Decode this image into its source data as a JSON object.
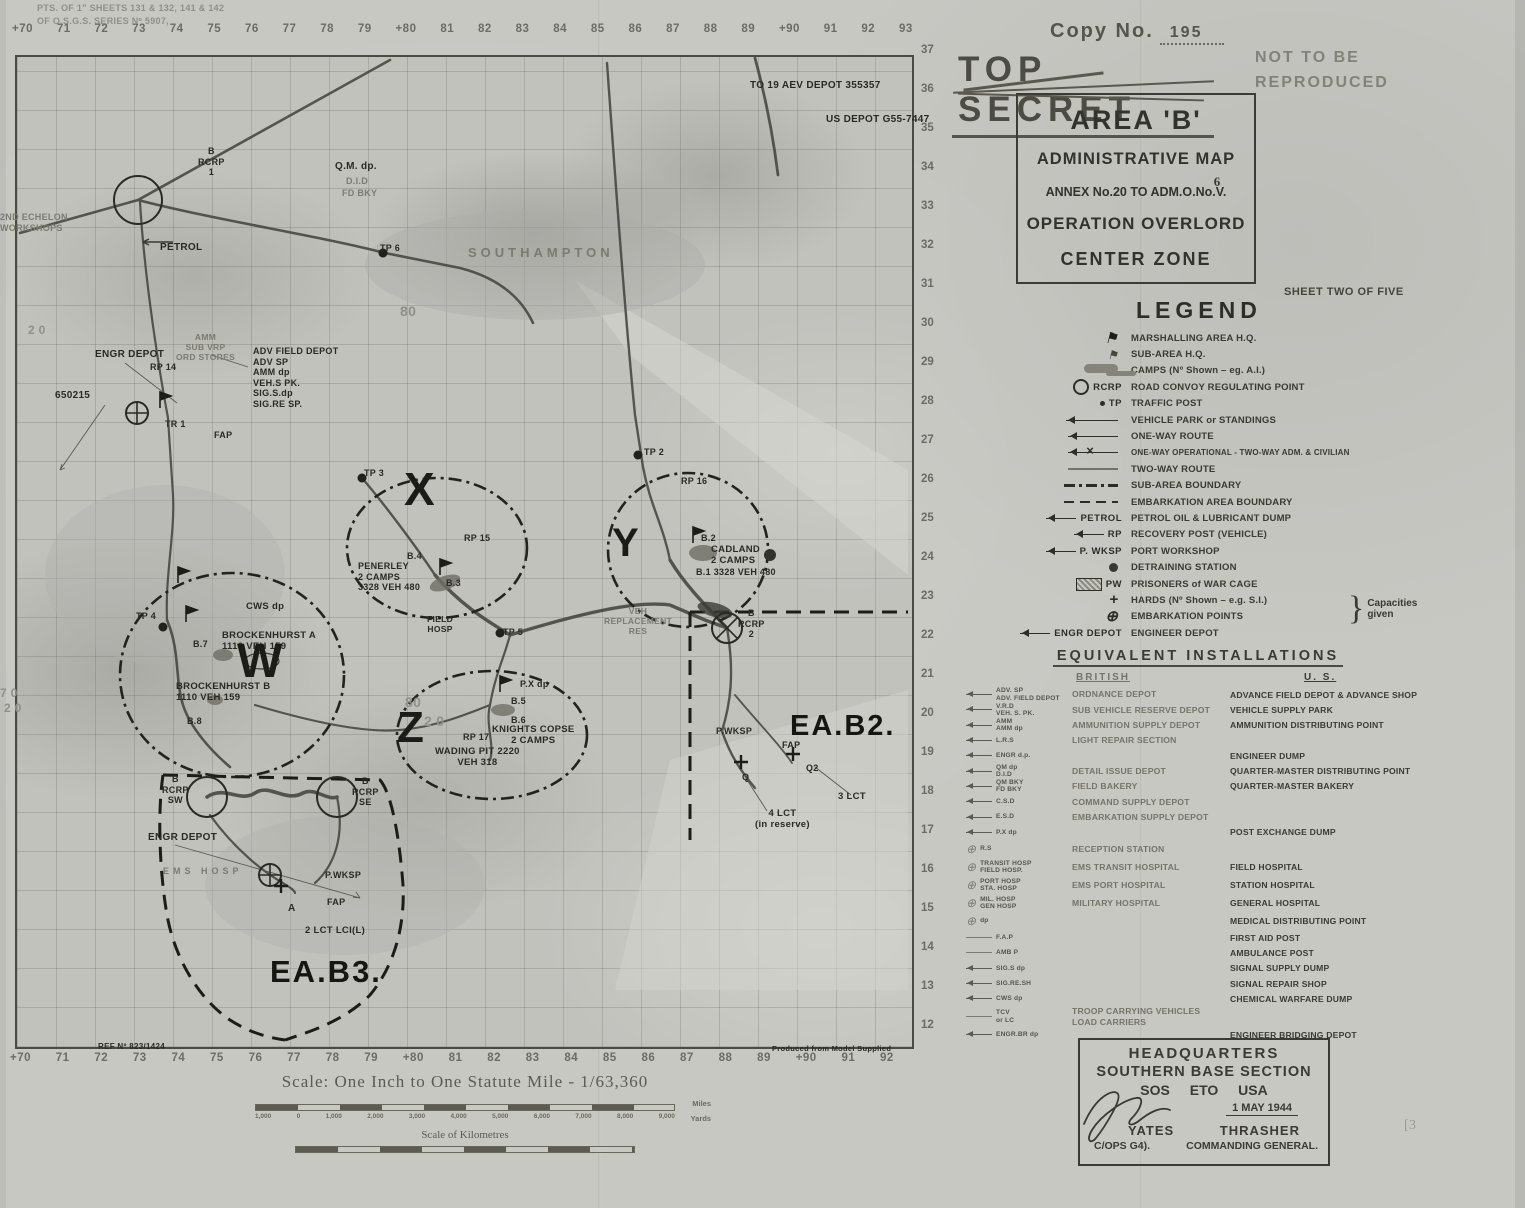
{
  "header": {
    "copy_prefix": "Copy  No.",
    "copy_number": "195",
    "classification": "TOP SECRET",
    "not_reproduced": "NOT TO BE\nREPRODUCED",
    "area_title": "AREA 'B'",
    "subtitle": "ADMINISTRATIVE MAP",
    "annex_prefix": "ANNEX No.20 TO ADM.O.No.",
    "annex_v": "V.",
    "annex_six": "6",
    "operation": "OPERATION OVERLORD",
    "zone": "CENTER ZONE",
    "sheet": "SHEET TWO OF FIVE"
  },
  "legend": {
    "title": "LEGEND",
    "capacities_brace": "}",
    "capacities_note": "Capacities given",
    "items": [
      {
        "k": "flag1",
        "sym": "",
        "label": "MARSHALLING AREA H.Q."
      },
      {
        "k": "flag2",
        "sym": "",
        "label": "SUB-AREA H.Q."
      },
      {
        "k": "camp",
        "sym": "",
        "label": "CAMPS (Nº Shown – eg. A.I.)"
      },
      {
        "k": "rcrp",
        "sym": "RCRP",
        "label": "ROAD CONVOY REGULATING POINT"
      },
      {
        "k": "tp",
        "sym": "TP",
        "label": "TRAFFIC POST"
      },
      {
        "k": "apark",
        "sym": "",
        "label": "VEHICLE PARK or STANDINGS"
      },
      {
        "k": "oneway",
        "sym": "",
        "label": "ONE-WAY ROUTE"
      },
      {
        "k": "onewayx",
        "sym": "",
        "label": "ONE-WAY OPERATIONAL - TWO-WAY ADM. & CIVILIAN",
        "lcls": "sm"
      },
      {
        "k": "twoway",
        "sym": "",
        "label": "TWO-WAY ROUTE"
      },
      {
        "k": "dashdot",
        "sym": "",
        "label": "SUB-AREA BOUNDARY"
      },
      {
        "k": "dashed",
        "sym": "",
        "label": "EMBARKATION AREA BOUNDARY"
      },
      {
        "k": "arrow",
        "sym": "PETROL",
        "label": "PETROL OIL & LUBRICANT DUMP"
      },
      {
        "k": "arrow",
        "sym": "RP",
        "label": "RECOVERY POST (VEHICLE)"
      },
      {
        "k": "arrow",
        "sym": "P. WKSP",
        "label": "PORT WORKSHOP"
      },
      {
        "k": "dot",
        "sym": "",
        "label": "DETRAINING STATION"
      },
      {
        "k": "pw",
        "sym": "PW",
        "label": "PRISONERS of WAR CAGE"
      },
      {
        "k": "plus",
        "sym": "",
        "label": "HARDS (Nº Shown – e.g. S.I.)"
      },
      {
        "k": "oplus",
        "sym": "",
        "label": "EMBARKATION POINTS"
      },
      {
        "k": "arrow",
        "sym": "ENGR DEPOT",
        "label": "ENGINEER DEPOT"
      }
    ]
  },
  "equivalents": {
    "title": "EQUIVALENT  INSTALLATIONS",
    "british_header": "BRITISH",
    "us_header": "U. S.",
    "rows": [
      {
        "k": "a",
        "sym": "ADV. SP\nADV. FIELD DEPOT",
        "brit": "ORDNANCE DEPOT",
        "us": "ADVANCE FIELD DEPOT & ADVANCE SHOP"
      },
      {
        "k": "a",
        "sym": "V.R.D\nVEH. S. PK.",
        "brit": "SUB VEHICLE RESERVE DEPOT",
        "us": "VEHICLE SUPPLY PARK"
      },
      {
        "k": "a",
        "sym": "AMM\nAMM dp",
        "brit": "AMMUNITION SUPPLY DEPOT",
        "us": "AMMUNITION DISTRIBUTING POINT"
      },
      {
        "k": "a",
        "sym": "L.R.S",
        "brit": "LIGHT REPAIR SECTION",
        "us": ""
      },
      {
        "k": "a",
        "sym": "ENGR d.p.",
        "brit": "",
        "us": "ENGINEER DUMP"
      },
      {
        "k": "a",
        "sym": "QM dp\nD.I.D",
        "brit": "DETAIL ISSUE DEPOT",
        "us": "QUARTER-MASTER DISTRIBUTING POINT"
      },
      {
        "k": "a",
        "sym": "QM BKY\nFD BKY",
        "brit": "FIELD BAKERY",
        "us": "QUARTER-MASTER BAKERY"
      },
      {
        "k": "a",
        "sym": "C.S.D",
        "brit": "COMMAND SUPPLY DEPOT",
        "us": ""
      },
      {
        "k": "a",
        "sym": "E.S.D",
        "brit": "EMBARKATION SUPPLY DEPOT",
        "us": ""
      },
      {
        "k": "a",
        "sym": "P.X dp",
        "brit": "",
        "us": "POST EXCHANGE DUMP"
      },
      {
        "k": "o",
        "sym": "R.S",
        "brit": "RECEPTION STATION",
        "us": ""
      },
      {
        "k": "o",
        "sym": "TRANSIT HOSP\nFIELD HOSP.",
        "brit": "EMS TRANSIT HOSPITAL",
        "us": "FIELD HOSPITAL"
      },
      {
        "k": "o",
        "sym": "PORT HOSP\nSTA. HOSP",
        "brit": "EMS PORT HOSPITAL",
        "us": "STATION HOSPITAL"
      },
      {
        "k": "o",
        "sym": "MIL. HOSP\nGEN HOSP",
        "brit": "MILITARY HOSPITAL",
        "us": "GENERAL HOSPITAL"
      },
      {
        "k": "o",
        "sym": "dp",
        "brit": "",
        "us": "MEDICAL DISTRIBUTING POINT"
      },
      {
        "k": "l",
        "sym": "F.A.P",
        "brit": "",
        "us": "FIRST AID POST"
      },
      {
        "k": "l",
        "sym": "AMB P",
        "brit": "",
        "us": "AMBULANCE POST"
      },
      {
        "k": "a",
        "sym": "SIG.S dp",
        "brit": "",
        "us": "SIGNAL SUPPLY DUMP"
      },
      {
        "k": "a",
        "sym": "SIG.RE.SH",
        "brit": "",
        "us": "SIGNAL REPAIR SHOP"
      },
      {
        "k": "a",
        "sym": "CWS dp",
        "brit": "",
        "us": "CHEMICAL WARFARE DUMP"
      },
      {
        "k": "l",
        "sym": "TCV\nor LC",
        "brit": "TROOP CARRYING VEHICLES\nLOAD CARRIERS",
        "us": ""
      },
      {
        "k": "a",
        "sym": "ENGR.BR dp",
        "brit": "",
        "us": "ENGINEER BRIDGING DEPOT"
      }
    ]
  },
  "hq": {
    "line1": "HEADQUARTERS",
    "line2": "SOUTHERN BASE SECTION",
    "line3": "SOS ETO USA",
    "date": "1 MAY 1944",
    "left_name": "YATES",
    "right_name": "THRASHER",
    "left_role": "C/OPS G4).",
    "right_role": "COMMANDING GENERAL."
  },
  "scale": {
    "title": "Scale: One Inch to One Statute Mile - 1/63,360",
    "miles_label": "Miles",
    "yards_label": "Yards",
    "yards": [
      "1,000",
      "0",
      "1,000",
      "2,000",
      "3,000",
      "4,000",
      "5,000",
      "6,000",
      "7,000",
      "8,000",
      "9,000"
    ],
    "km_title": "Scale of Kilometres"
  },
  "annotations": {
    "pencil_mark": "[3"
  },
  "map": {
    "grid_top": [
      "+70",
      "71",
      "72",
      "73",
      "74",
      "75",
      "76",
      "77",
      "78",
      "79",
      "+80",
      "81",
      "82",
      "83",
      "84",
      "85",
      "86",
      "87",
      "88",
      "89",
      "+90",
      "91",
      "92",
      "93"
    ],
    "grid_bottom": [
      "+70",
      "71",
      "72",
      "73",
      "74",
      "75",
      "76",
      "77",
      "78",
      "79",
      "+80",
      "81",
      "82",
      "83",
      "84",
      "85",
      "86",
      "87",
      "88",
      "89",
      "+90",
      "91",
      "92"
    ],
    "grid_right": [
      "37",
      "36",
      "35",
      "34",
      "33",
      "32",
      "31",
      "30",
      "29",
      "28",
      "27",
      "26",
      "25",
      "24",
      "23",
      "22",
      "21",
      "20",
      "19",
      "18",
      "17",
      "16",
      "15",
      "14",
      "13",
      "12"
    ],
    "labels": [
      {
        "t": "PTS. OF 1\" SHEETS 131 & 132, 141 & 142",
        "x": 37,
        "y": 3,
        "fs": 9,
        "cls": "faint2",
        "n": "sheet-source-note"
      },
      {
        "t": "OF O.S.G.S. SERIES Nº 5907,",
        "x": 37,
        "y": 16,
        "fs": 9,
        "cls": "faint2",
        "n": "sheet-source-note"
      },
      {
        "t": "TO 19 AEV DEPOT  355357",
        "x": 750,
        "y": 80,
        "fs": 10,
        "cls": "dk"
      },
      {
        "t": "US DEPOT G55-7447",
        "x": 826,
        "y": 114,
        "fs": 10,
        "cls": "dk"
      },
      {
        "t": "B\nRCRP\n1",
        "x": 198,
        "y": 146,
        "fs": 9,
        "cls": "dk ctr"
      },
      {
        "t": "Q.M. dp.",
        "x": 335,
        "y": 161,
        "fs": 10,
        "cls": "dk"
      },
      {
        "t": "D.I.D",
        "x": 346,
        "y": 176,
        "fs": 9,
        "cls": "faint"
      },
      {
        "t": "FD BKY",
        "x": 342,
        "y": 188,
        "fs": 9,
        "cls": "faint"
      },
      {
        "t": "2ND ECHELON\nWORKSHOPS",
        "x": 0,
        "y": 212,
        "fs": 9,
        "cls": "faint"
      },
      {
        "t": "PETROL",
        "x": 160,
        "y": 242,
        "fs": 10,
        "cls": "dk"
      },
      {
        "t": "SOUTHAMPTON",
        "x": 468,
        "y": 245,
        "fs": 13,
        "cls": "faint sp",
        "n": "city-label-southampton"
      },
      {
        "t": "TP 6",
        "x": 380,
        "y": 243,
        "fs": 9,
        "cls": "dk"
      },
      {
        "t": "ENGR DEPOT",
        "x": 95,
        "y": 349,
        "fs": 10,
        "cls": "dk"
      },
      {
        "t": "AMM\nSUB VRP\nORD STORES",
        "x": 176,
        "y": 332,
        "fs": 8.5,
        "cls": "faint ctr"
      },
      {
        "t": "ADV FIELD DEPOT\nADV SP\nAMM dp\nVEH.S PK.\nSIG.S.dp\nSIG.RE SP.",
        "x": 253,
        "y": 346,
        "fs": 9,
        "cls": "dk"
      },
      {
        "t": "RP 14",
        "x": 150,
        "y": 362,
        "fs": 9,
        "cls": "dk"
      },
      {
        "t": "650215",
        "x": 55,
        "y": 390,
        "fs": 10,
        "cls": "dk"
      },
      {
        "t": "TR 1",
        "x": 165,
        "y": 419,
        "fs": 9,
        "cls": "dk"
      },
      {
        "t": "FAP",
        "x": 214,
        "y": 430,
        "fs": 9,
        "cls": "dk"
      },
      {
        "t": "TP 3",
        "x": 364,
        "y": 468,
        "fs": 9,
        "cls": "dk"
      },
      {
        "t": "X",
        "x": 404,
        "y": 466,
        "fs": 46,
        "cls": "zone",
        "n": "zone-x-label"
      },
      {
        "t": "RP 15",
        "x": 464,
        "y": 533,
        "fs": 9,
        "cls": "dk"
      },
      {
        "t": "B.4",
        "x": 407,
        "y": 551,
        "fs": 9,
        "cls": "dk"
      },
      {
        "t": "PENERLEY\n2 CAMPS\n3328 VEH 480",
        "x": 358,
        "y": 561,
        "fs": 9,
        "cls": "dk"
      },
      {
        "t": "B.3",
        "x": 446,
        "y": 578,
        "fs": 9,
        "cls": "dk"
      },
      {
        "t": "TP 2",
        "x": 644,
        "y": 447,
        "fs": 9,
        "cls": "dk"
      },
      {
        "t": "RP 16",
        "x": 681,
        "y": 476,
        "fs": 9,
        "cls": "dk"
      },
      {
        "t": "Y",
        "x": 612,
        "y": 523,
        "fs": 40,
        "cls": "zone",
        "n": "zone-y-label"
      },
      {
        "t": "B.2",
        "x": 701,
        "y": 533,
        "fs": 9,
        "cls": "dk"
      },
      {
        "t": "CADLAND\n2 CAMPS",
        "x": 711,
        "y": 544,
        "fs": 9.5,
        "cls": "dk"
      },
      {
        "t": "B.1 3328 VEH 480",
        "x": 696,
        "y": 567,
        "fs": 9,
        "cls": "dk"
      },
      {
        "t": "B\nRCRP\n2",
        "x": 738,
        "y": 608,
        "fs": 9,
        "cls": "dk ctr"
      },
      {
        "t": "VEH\nREPLACEMENT\nRES",
        "x": 604,
        "y": 606,
        "fs": 8.5,
        "cls": "faint ctr"
      },
      {
        "t": "TP 4",
        "x": 136,
        "y": 611,
        "fs": 9,
        "cls": "dk"
      },
      {
        "t": "CWS dp",
        "x": 246,
        "y": 601,
        "fs": 9.5,
        "cls": "dk"
      },
      {
        "t": "B.7",
        "x": 193,
        "y": 639,
        "fs": 9,
        "cls": "dk"
      },
      {
        "t": "BROCKENHURST A\n1110   VEH 159",
        "x": 222,
        "y": 630,
        "fs": 9.5,
        "cls": "dk"
      },
      {
        "t": "W",
        "x": 237,
        "y": 638,
        "fs": 48,
        "cls": "zone",
        "n": "zone-w-label"
      },
      {
        "t": "BROCKENHURST B\n1110   VEH 159",
        "x": 176,
        "y": 681,
        "fs": 9.5,
        "cls": "dk"
      },
      {
        "t": "B.8",
        "x": 187,
        "y": 716,
        "fs": 9,
        "cls": "dk"
      },
      {
        "t": "Z",
        "x": 397,
        "y": 706,
        "fs": 44,
        "cls": "zone",
        "n": "zone-z-label"
      },
      {
        "t": "P.X dp",
        "x": 520,
        "y": 679,
        "fs": 9,
        "cls": "dk"
      },
      {
        "t": "B.5",
        "x": 511,
        "y": 696,
        "fs": 9,
        "cls": "dk"
      },
      {
        "t": "B.6",
        "x": 511,
        "y": 715,
        "fs": 9,
        "cls": "dk"
      },
      {
        "t": "KNIGHTS COPSE\n2 CAMPS",
        "x": 492,
        "y": 724,
        "fs": 9.5,
        "cls": "dk ctr"
      },
      {
        "t": "RP 17",
        "x": 463,
        "y": 732,
        "fs": 9,
        "cls": "dk"
      },
      {
        "t": "WADING PIT 2220\nVEH 318",
        "x": 435,
        "y": 746,
        "fs": 9.5,
        "cls": "dk ctr"
      },
      {
        "t": "TP 5",
        "x": 503,
        "y": 627,
        "fs": 9,
        "cls": "dk"
      },
      {
        "t": "FIELD\nHOSP",
        "x": 427,
        "y": 614,
        "fs": 8.5,
        "cls": "dk ctr"
      },
      {
        "t": "P.WKSP",
        "x": 716,
        "y": 726,
        "fs": 9,
        "cls": "dk"
      },
      {
        "t": "EA.B2.",
        "x": 790,
        "y": 712,
        "fs": 29,
        "cls": "big",
        "n": "area-eab2-label"
      },
      {
        "t": "FAP",
        "x": 782,
        "y": 740,
        "fs": 9,
        "cls": "dk"
      },
      {
        "t": "Q2",
        "x": 806,
        "y": 763,
        "fs": 9,
        "cls": "dk"
      },
      {
        "t": "Q",
        "x": 742,
        "y": 772,
        "fs": 9,
        "cls": "dk"
      },
      {
        "t": "3 LCT",
        "x": 838,
        "y": 791,
        "fs": 9.5,
        "cls": "dk"
      },
      {
        "t": "4 LCT\n(in reserve)",
        "x": 755,
        "y": 808,
        "fs": 9.5,
        "cls": "dk ctr"
      },
      {
        "t": "B\nRCRP\nSW",
        "x": 162,
        "y": 774,
        "fs": 9,
        "cls": "dk ctr"
      },
      {
        "t": "B\nRCRP\nSE",
        "x": 352,
        "y": 776,
        "fs": 9,
        "cls": "dk ctr"
      },
      {
        "t": "ENGR DEPOT",
        "x": 148,
        "y": 832,
        "fs": 10,
        "cls": "dk"
      },
      {
        "t": "EMS HOSP",
        "x": 163,
        "y": 866,
        "fs": 9,
        "cls": "faint sp"
      },
      {
        "t": "P.WKSP",
        "x": 325,
        "y": 870,
        "fs": 9,
        "cls": "dk"
      },
      {
        "t": "FAP",
        "x": 327,
        "y": 897,
        "fs": 9,
        "cls": "dk"
      },
      {
        "t": "A",
        "x": 288,
        "y": 903,
        "fs": 10,
        "cls": "dk"
      },
      {
        "t": "2 LCT LCI(L)",
        "x": 305,
        "y": 925,
        "fs": 9.5,
        "cls": "dk"
      },
      {
        "t": "EA.B3.",
        "x": 270,
        "y": 956,
        "fs": 31,
        "cls": "big",
        "n": "area-eab3-label"
      },
      {
        "t": "REF Nº 823/1424",
        "x": 98,
        "y": 1042,
        "fs": 8,
        "cls": "dk"
      },
      {
        "t": "Produced from Model Supplied",
        "x": 772,
        "y": 1045,
        "fs": 7.5,
        "cls": "dk"
      },
      {
        "t": "80",
        "x": 400,
        "y": 303,
        "fs": 14,
        "cls": "faint2"
      },
      {
        "t": "80",
        "x": 405,
        "y": 694,
        "fs": 14,
        "cls": "faint2"
      },
      {
        "t": "2 0",
        "x": 424,
        "y": 713,
        "fs": 14,
        "cls": "faint2"
      },
      {
        "t": "2 0",
        "x": 28,
        "y": 323,
        "fs": 12,
        "cls": "faint2"
      },
      {
        "t": "7 0",
        "x": 0,
        "y": 686,
        "fs": 12,
        "cls": "faint2"
      },
      {
        "t": "2 0",
        "x": 4,
        "y": 701,
        "fs": 12,
        "cls": "faint2"
      }
    ]
  }
}
